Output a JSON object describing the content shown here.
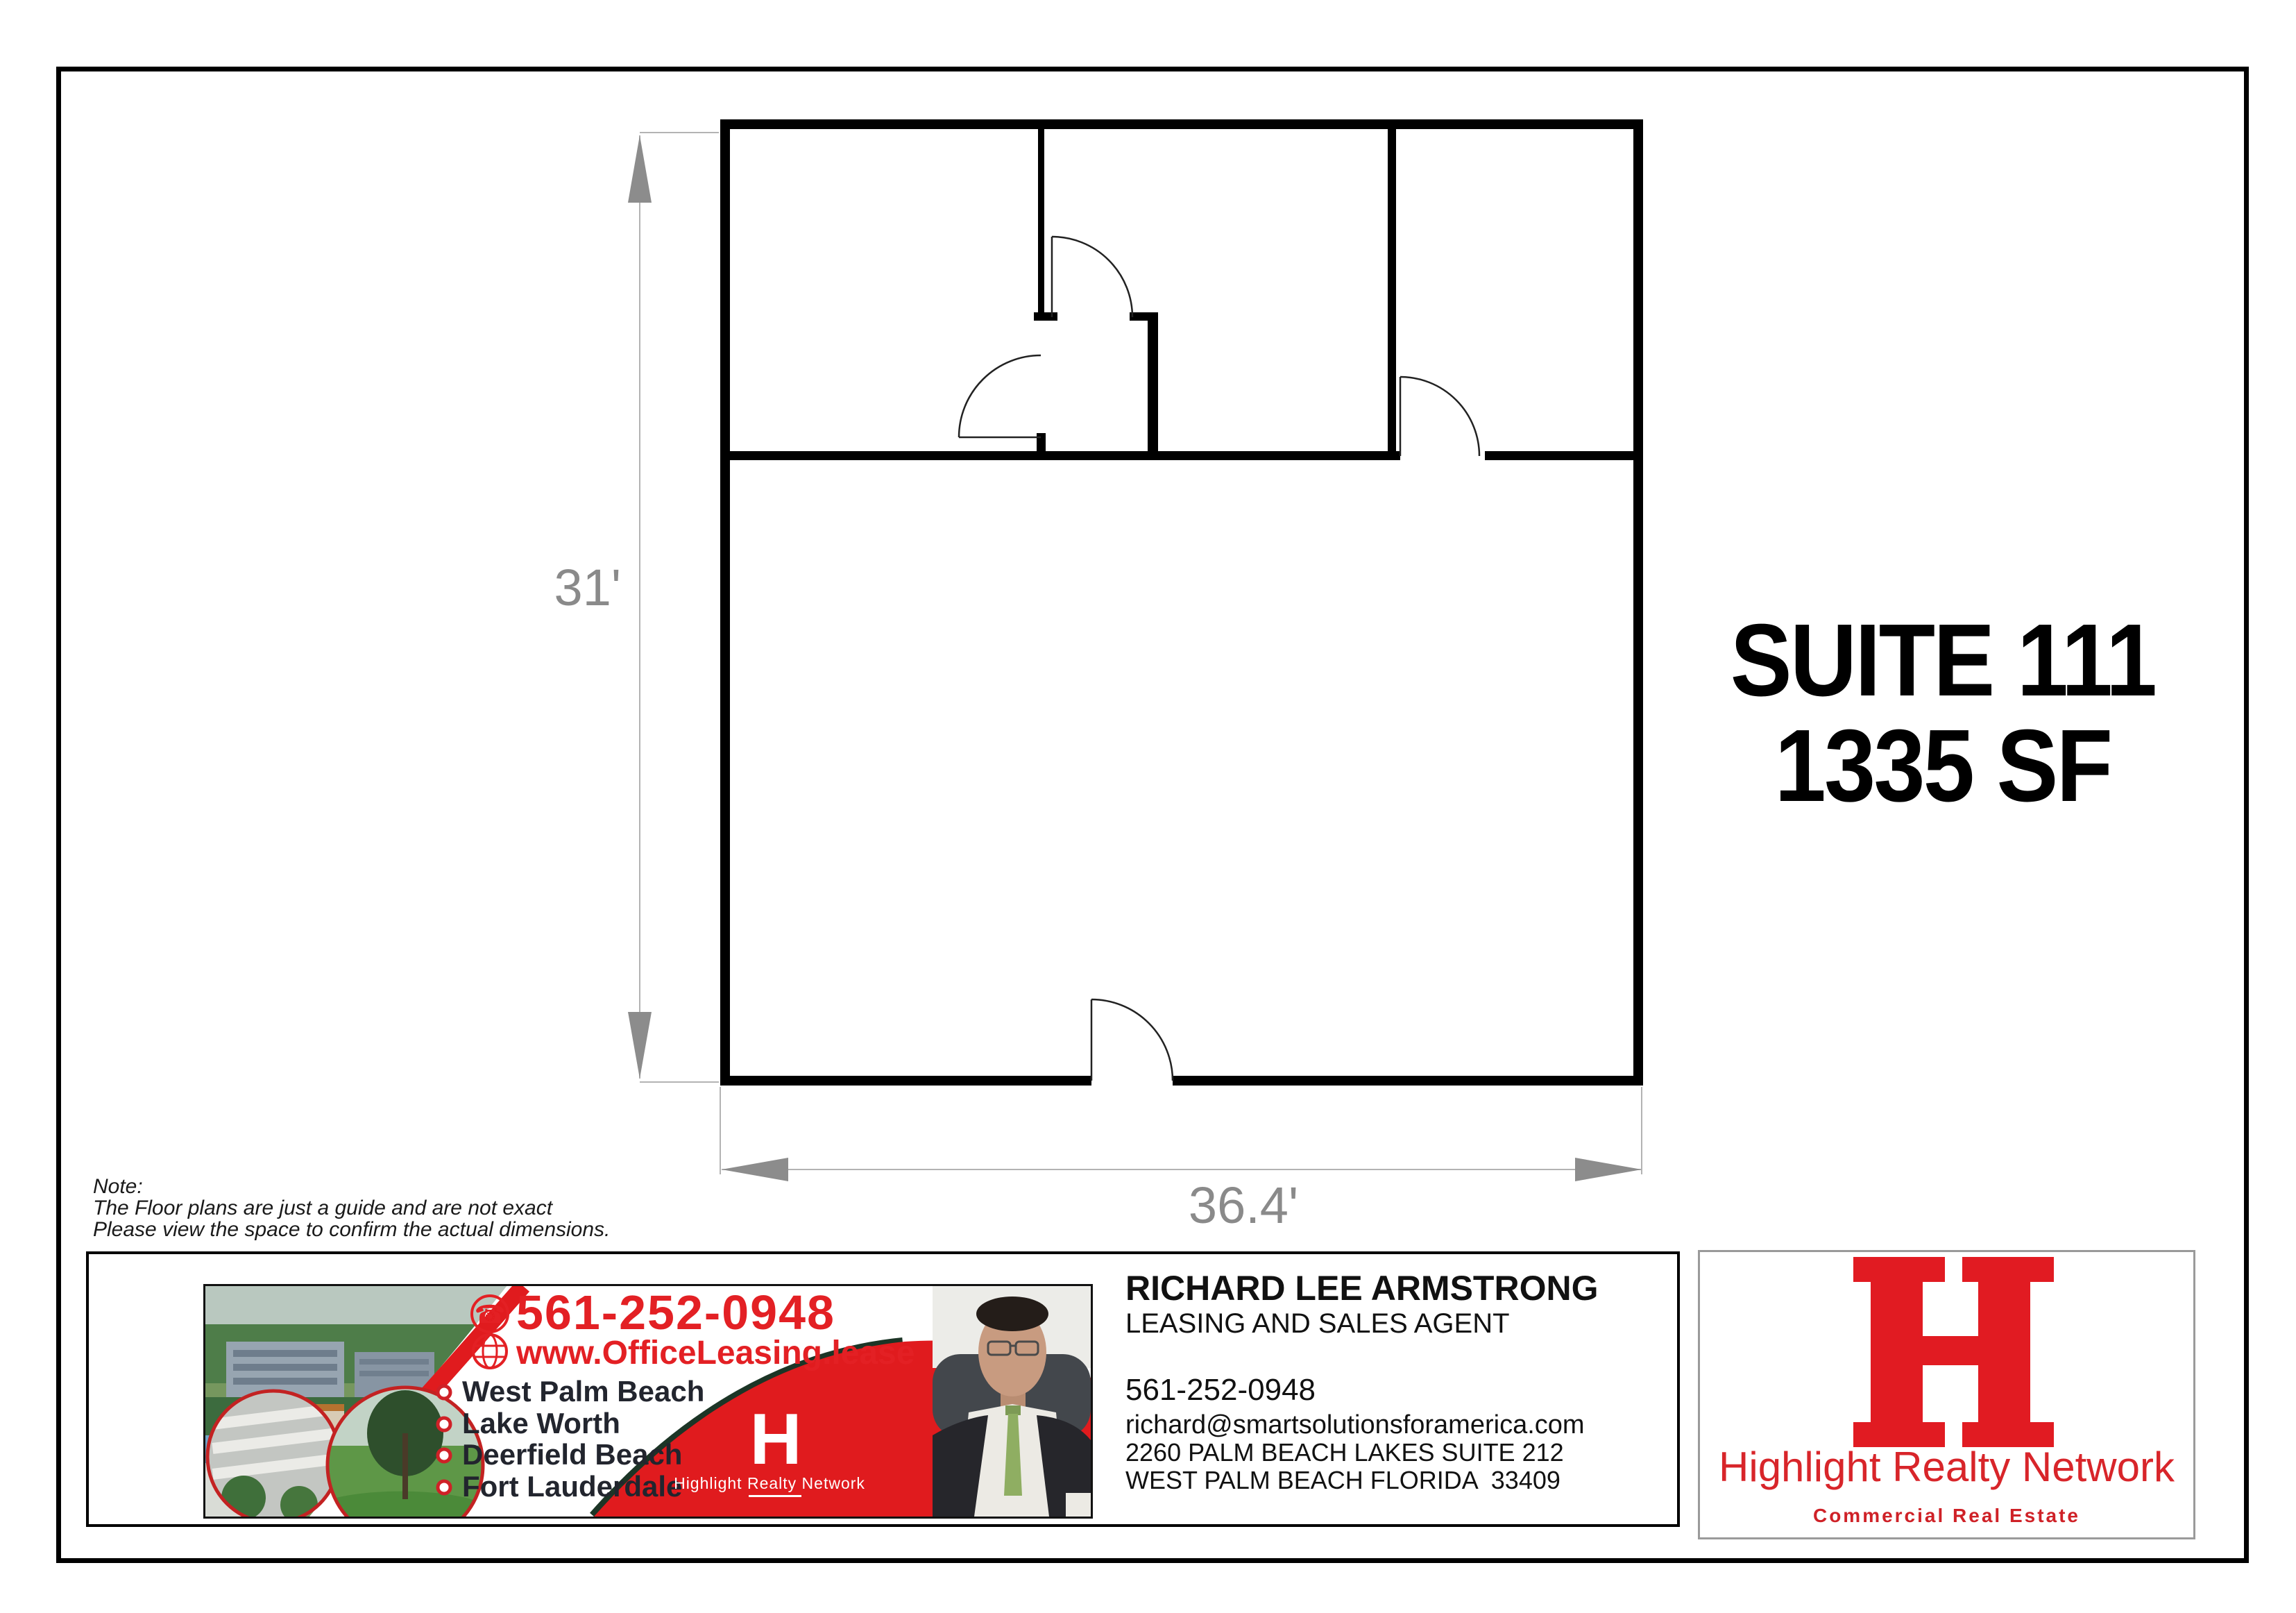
{
  "suite": {
    "line1": "SUITE 111",
    "line2": "1335 SF"
  },
  "dims": {
    "height": "31'",
    "width": "36.4'"
  },
  "note": {
    "heading": "Note:",
    "line1": "The Floor plans are just a guide and are not exact",
    "line2": "Please view the space to confirm the actual dimensions."
  },
  "ad": {
    "phone": "561-252-0948",
    "phone_glyph": "☎",
    "website": "www.OfficeLeasing.lease",
    "cities": [
      "West Palm Beach",
      "Lake Worth",
      "Deerfield Beach",
      "Fort Lauderdale"
    ],
    "logo_letter": "H",
    "network_label": "Highlight Realty Network",
    "red": "#e01b1e"
  },
  "agent": {
    "name": "RICHARD LEE ARMSTRONG",
    "title": "LEASING AND SALES AGENT",
    "phone": "561-252-0948",
    "email": "richard@smartsolutionsforamerica.com",
    "address1": "2260 PALM BEACH LAKES SUITE 212",
    "address2": "WEST PALM BEACH FLORIDA  33409"
  },
  "brand": {
    "logo_letter": "H",
    "name": "Highlight Realty Network",
    "tagline": "Commercial Real Estate",
    "red": "#d8252a"
  },
  "colors": {
    "wall": "#000000",
    "dim_gray": "#8a8a8a"
  }
}
